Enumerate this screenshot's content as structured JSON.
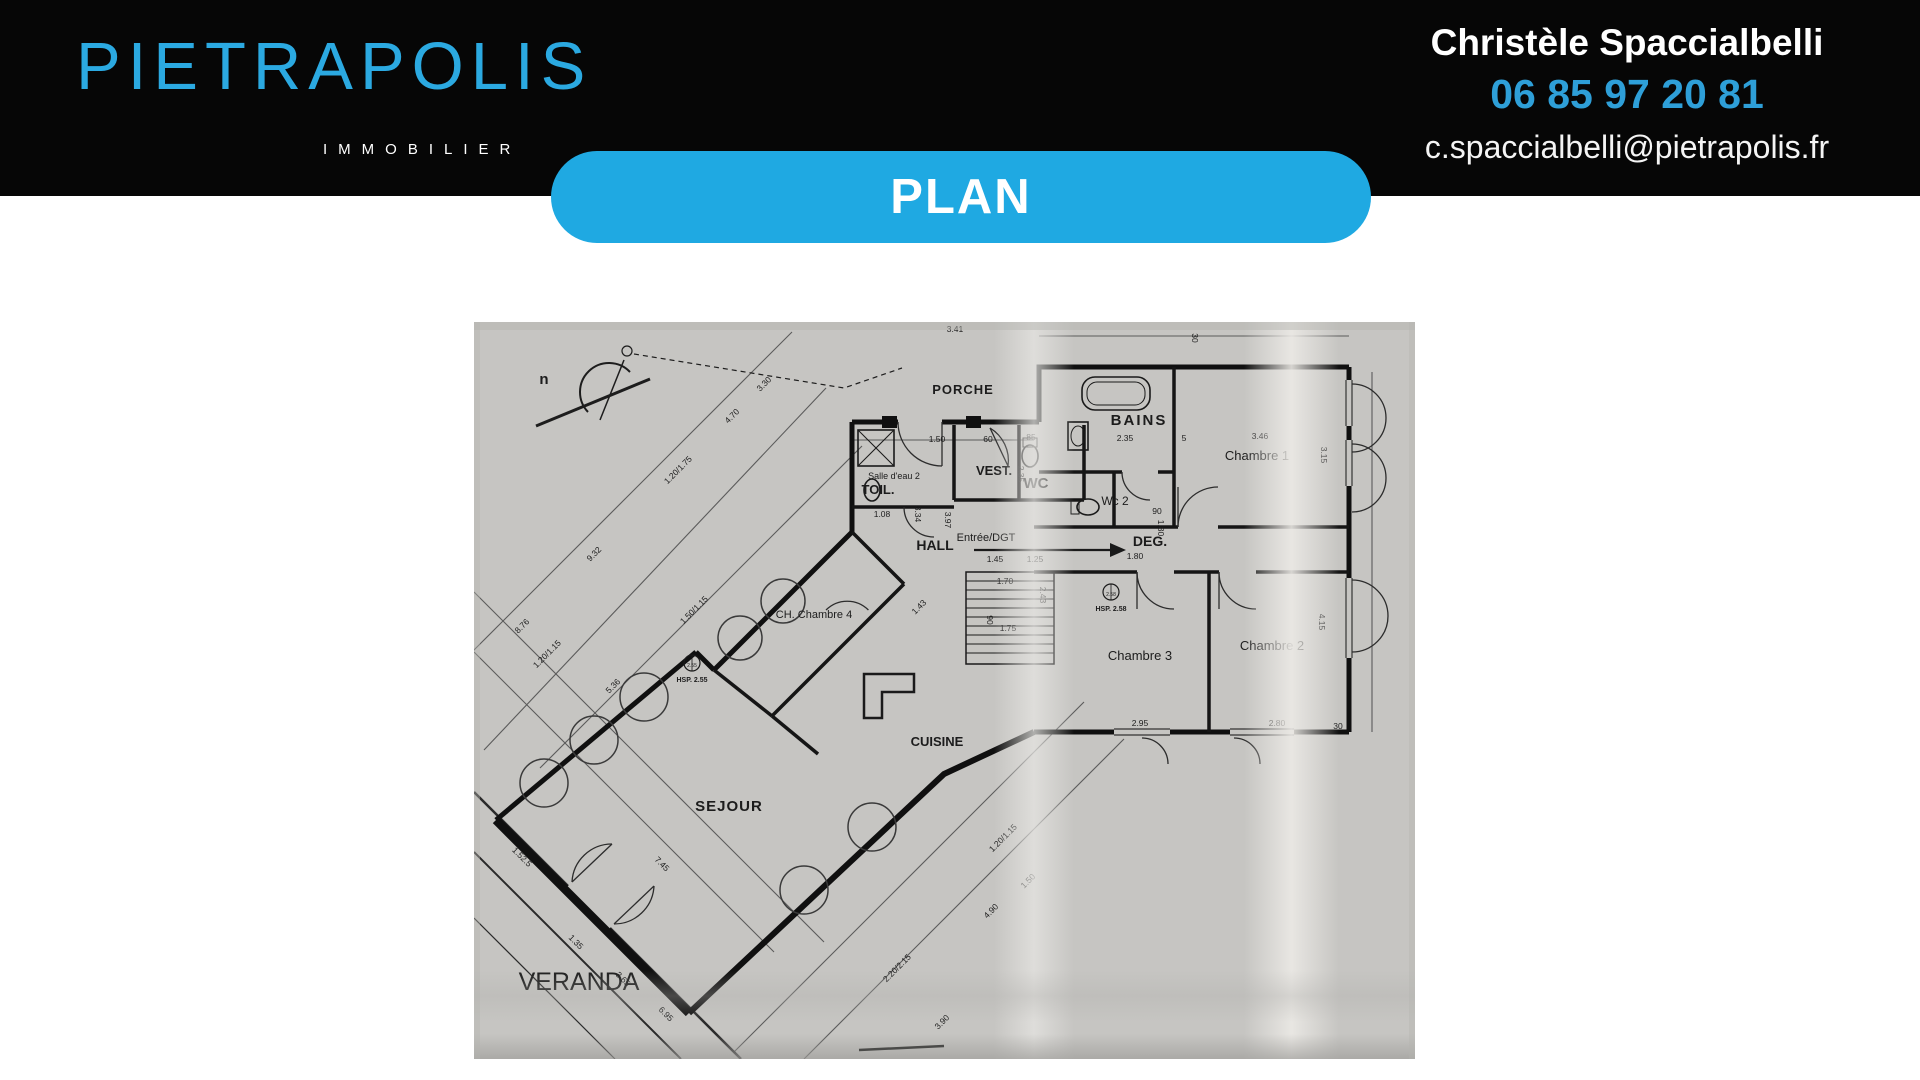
{
  "header": {
    "brand": "PIETRAPOLIS",
    "tagline": "IMMOBILIER",
    "contact": {
      "name": "Christèle Spaccialbelli",
      "phone": "06 85 97 20 81",
      "email": "c.spaccialbelli@pietrapolis.fr"
    },
    "colors": {
      "header_bg": "#060606",
      "logo_blue": "#2BA9E1",
      "phone_blue": "#2E9FD8"
    }
  },
  "banner": {
    "label": "PLAN",
    "bg": "#1FA9E2"
  },
  "floorplan": {
    "paper_color": "#c6c5c2",
    "ink_color": "#141414",
    "rooms": [
      {
        "t": "PORCHE",
        "x": 489,
        "y": 72,
        "size": 13,
        "weight": "bold",
        "spacing": 1
      },
      {
        "t": "BAINS",
        "x": 665,
        "y": 103,
        "size": 15,
        "weight": "bold",
        "spacing": 2
      },
      {
        "t": "Chambre 1",
        "x": 783,
        "y": 138,
        "size": 13
      },
      {
        "t": "VEST.",
        "x": 520,
        "y": 153,
        "size": 13,
        "weight": "bold"
      },
      {
        "t": "WC",
        "x": 562,
        "y": 166,
        "size": 15,
        "weight": "bold"
      },
      {
        "t": "Salle d'eau 2",
        "x": 420,
        "y": 157,
        "size": 9
      },
      {
        "t": "TOIL.",
        "x": 404,
        "y": 172,
        "size": 13,
        "weight": "bold"
      },
      {
        "t": "Wc 2",
        "x": 641,
        "y": 183,
        "size": 12
      },
      {
        "t": "DEG.",
        "x": 676,
        "y": 224,
        "size": 14,
        "weight": "bold"
      },
      {
        "t": "HALL",
        "x": 461,
        "y": 228,
        "size": 14,
        "weight": "bold"
      },
      {
        "t": "Entrée/DGT",
        "x": 512,
        "y": 219,
        "size": 11
      },
      {
        "t": "CH. Chambre 4",
        "x": 340,
        "y": 296,
        "size": 11
      },
      {
        "t": "Chambre 3",
        "x": 666,
        "y": 338,
        "size": 13
      },
      {
        "t": "Chambre 2",
        "x": 798,
        "y": 328,
        "size": 13
      },
      {
        "t": "CUISINE",
        "x": 463,
        "y": 424,
        "size": 13,
        "weight": "bold"
      },
      {
        "t": "SEJOUR",
        "x": 255,
        "y": 489,
        "size": 15,
        "weight": "bold",
        "spacing": 1
      },
      {
        "t": "VERANDA",
        "x": 105,
        "y": 668,
        "size": 25,
        "fill": "#3d3d3d"
      },
      {
        "t": "HSP. 2.55",
        "x": 218,
        "y": 360,
        "size": 7,
        "weight": "bold"
      },
      {
        "t": "HSP. 2.58",
        "x": 637,
        "y": 289,
        "size": 7,
        "weight": "bold"
      },
      {
        "t": "n",
        "x": 70,
        "y": 62,
        "size": 15,
        "weight": "bold"
      }
    ],
    "dims": [
      {
        "t": "3.41",
        "x": 481,
        "y": 10
      },
      {
        "t": "1.50",
        "x": 463,
        "y": 120
      },
      {
        "t": "60",
        "x": 514,
        "y": 120
      },
      {
        "t": "85",
        "x": 557,
        "y": 118
      },
      {
        "t": "2.35",
        "x": 651,
        "y": 119
      },
      {
        "t": "5",
        "x": 710,
        "y": 119
      },
      {
        "t": "3.46",
        "x": 786,
        "y": 117
      },
      {
        "t": "1.08",
        "x": 408,
        "y": 195
      },
      {
        "t": "90",
        "x": 683,
        "y": 192
      },
      {
        "t": "1.80",
        "x": 661,
        "y": 237
      },
      {
        "t": "1.45",
        "x": 521,
        "y": 240
      },
      {
        "t": "1.25",
        "x": 561,
        "y": 240
      },
      {
        "t": "1.70",
        "x": 531,
        "y": 262
      },
      {
        "t": "1.75",
        "x": 534,
        "y": 309
      },
      {
        "t": "2.95",
        "x": 666,
        "y": 404
      },
      {
        "t": "2.80",
        "x": 803,
        "y": 404
      },
      {
        "t": "30",
        "x": 864,
        "y": 407
      },
      {
        "t": "3.15",
        "x": 847,
        "y": 133,
        "r": 90
      },
      {
        "t": "4.15",
        "x": 845,
        "y": 300,
        "r": 90
      },
      {
        "t": "3.34",
        "x": 441,
        "y": 192,
        "r": 90
      },
      {
        "t": "3.97",
        "x": 471,
        "y": 198,
        "r": 90
      },
      {
        "t": "2.35",
        "x": 544,
        "y": 152,
        "r": 90
      },
      {
        "t": "90",
        "x": 513,
        "y": 298,
        "r": 90
      },
      {
        "t": "2.43",
        "x": 566,
        "y": 273,
        "r": 90
      },
      {
        "t": "30",
        "x": 718,
        "y": 16,
        "r": 90
      },
      {
        "t": "1.80",
        "x": 684,
        "y": 206,
        "r": 90
      },
      {
        "t": "3.30",
        "x": 292,
        "y": 64,
        "r": -45
      },
      {
        "t": "4.70",
        "x": 260,
        "y": 96,
        "r": -45
      },
      {
        "t": "1.20/1.75",
        "x": 206,
        "y": 150,
        "r": -45
      },
      {
        "t": "9.32",
        "x": 122,
        "y": 234,
        "r": -45
      },
      {
        "t": "8.76",
        "x": 50,
        "y": 306,
        "r": -45
      },
      {
        "t": "1.50/1.15",
        "x": 222,
        "y": 290,
        "r": -45
      },
      {
        "t": "5.36",
        "x": 141,
        "y": 366,
        "r": -45
      },
      {
        "t": "1.20/1.15",
        "x": 75,
        "y": 334,
        "r": -45
      },
      {
        "t": "1.43",
        "x": 447,
        "y": 287,
        "r": -45
      },
      {
        "t": "1.52.5",
        "x": 46,
        "y": 537,
        "r": 45
      },
      {
        "t": "7.45",
        "x": 186,
        "y": 544,
        "r": 45
      },
      {
        "t": "1.35",
        "x": 100,
        "y": 622,
        "r": 45
      },
      {
        "t": "3.65",
        "x": 147,
        "y": 659,
        "r": 45
      },
      {
        "t": "6.95",
        "x": 190,
        "y": 694,
        "r": 45
      },
      {
        "t": "1.20/1.15",
        "x": 531,
        "y": 518,
        "r": -45
      },
      {
        "t": "1.50",
        "x": 556,
        "y": 561,
        "r": -45
      },
      {
        "t": "4.90",
        "x": 519,
        "y": 591,
        "r": -45
      },
      {
        "t": "3.90",
        "x": 470,
        "y": 702,
        "r": -45
      },
      {
        "t": "2.20/2.15",
        "x": 425,
        "y": 648,
        "r": -45
      },
      {
        "t": "2.55",
        "x": 218,
        "y": 345,
        "size": 5
      },
      {
        "t": "2.58",
        "x": 637,
        "y": 274,
        "size": 5
      }
    ]
  }
}
